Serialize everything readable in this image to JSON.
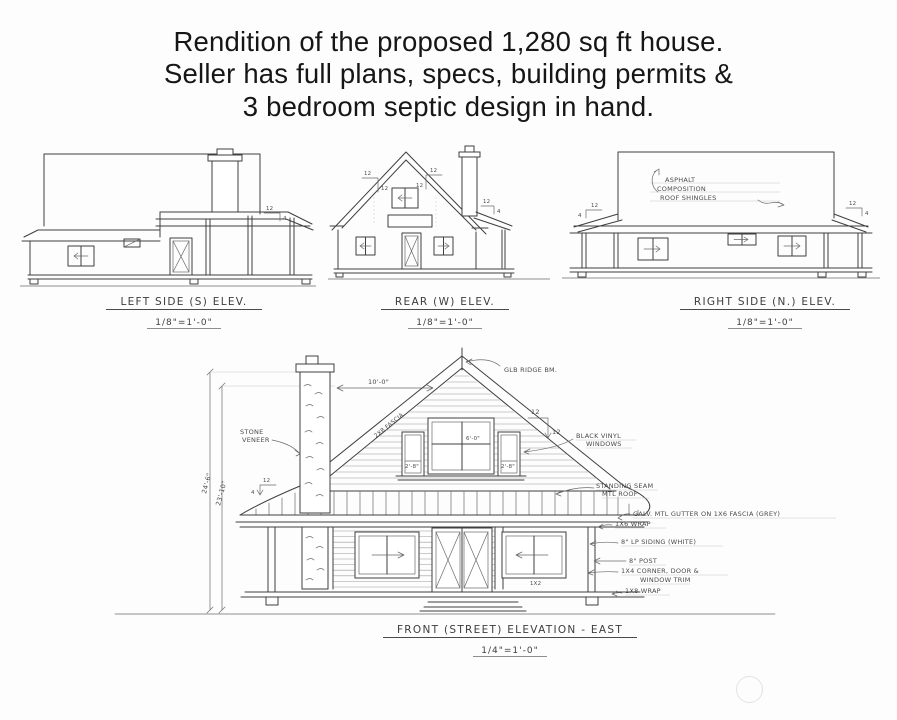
{
  "title": {
    "lines": [
      "Rendition of the proposed 1,280 sq ft house.",
      "Seller has full plans, specs, building permits &",
      "3 bedroom septic design in hand."
    ]
  },
  "captions": {
    "left": {
      "label": "LEFT SIDE (S) ELEV.",
      "scale": "1/8\"=1'-0\""
    },
    "rear": {
      "label": "REAR (W) ELEV.",
      "scale": "1/8\"=1'-0\""
    },
    "right": {
      "label": "RIGHT SIDE (N.) ELEV.",
      "scale": "1/8\"=1'-0\""
    },
    "front": {
      "label": "FRONT (STREET) ELEVATION - EAST",
      "scale": "1/4\"=1'-0\""
    }
  },
  "right_side": {
    "roof_note": [
      "ASPHALT",
      "COMPOSITION",
      "ROOF SHINGLES"
    ]
  },
  "slopes": {
    "main_run": "12",
    "main_rise": "12",
    "porch_run": "12",
    "porch_rise": "4"
  },
  "front": {
    "callouts": {
      "ridge": "GLB RIDGE BM.",
      "stone": [
        "STONE",
        "VENEER"
      ],
      "vinyl": [
        "BLACK VINYL",
        "WINDOWS"
      ],
      "seam": [
        "STANDING SEAM",
        "MTL ROOF"
      ],
      "gutter": "GALV. MTL GUTTER ON 1X6 FASCIA (GREY)",
      "wrap6": "1X6 WRAP",
      "siding": "8\" LP SIDING (WHITE)",
      "post": "8\" POST",
      "trim": [
        "1X4 CORNER, DOOR &",
        "WINDOW TRIM"
      ],
      "wrap8": "1X8 WRAP",
      "rake": "2X8 FASCIA",
      "window_trim_note": "1X2"
    },
    "dims": {
      "height_a": "24'-6\"",
      "height_b": "23'-10\"",
      "width_top": "10'-0\"",
      "attic_center": "6'-0\"",
      "attic_side": "2'-8\""
    }
  }
}
